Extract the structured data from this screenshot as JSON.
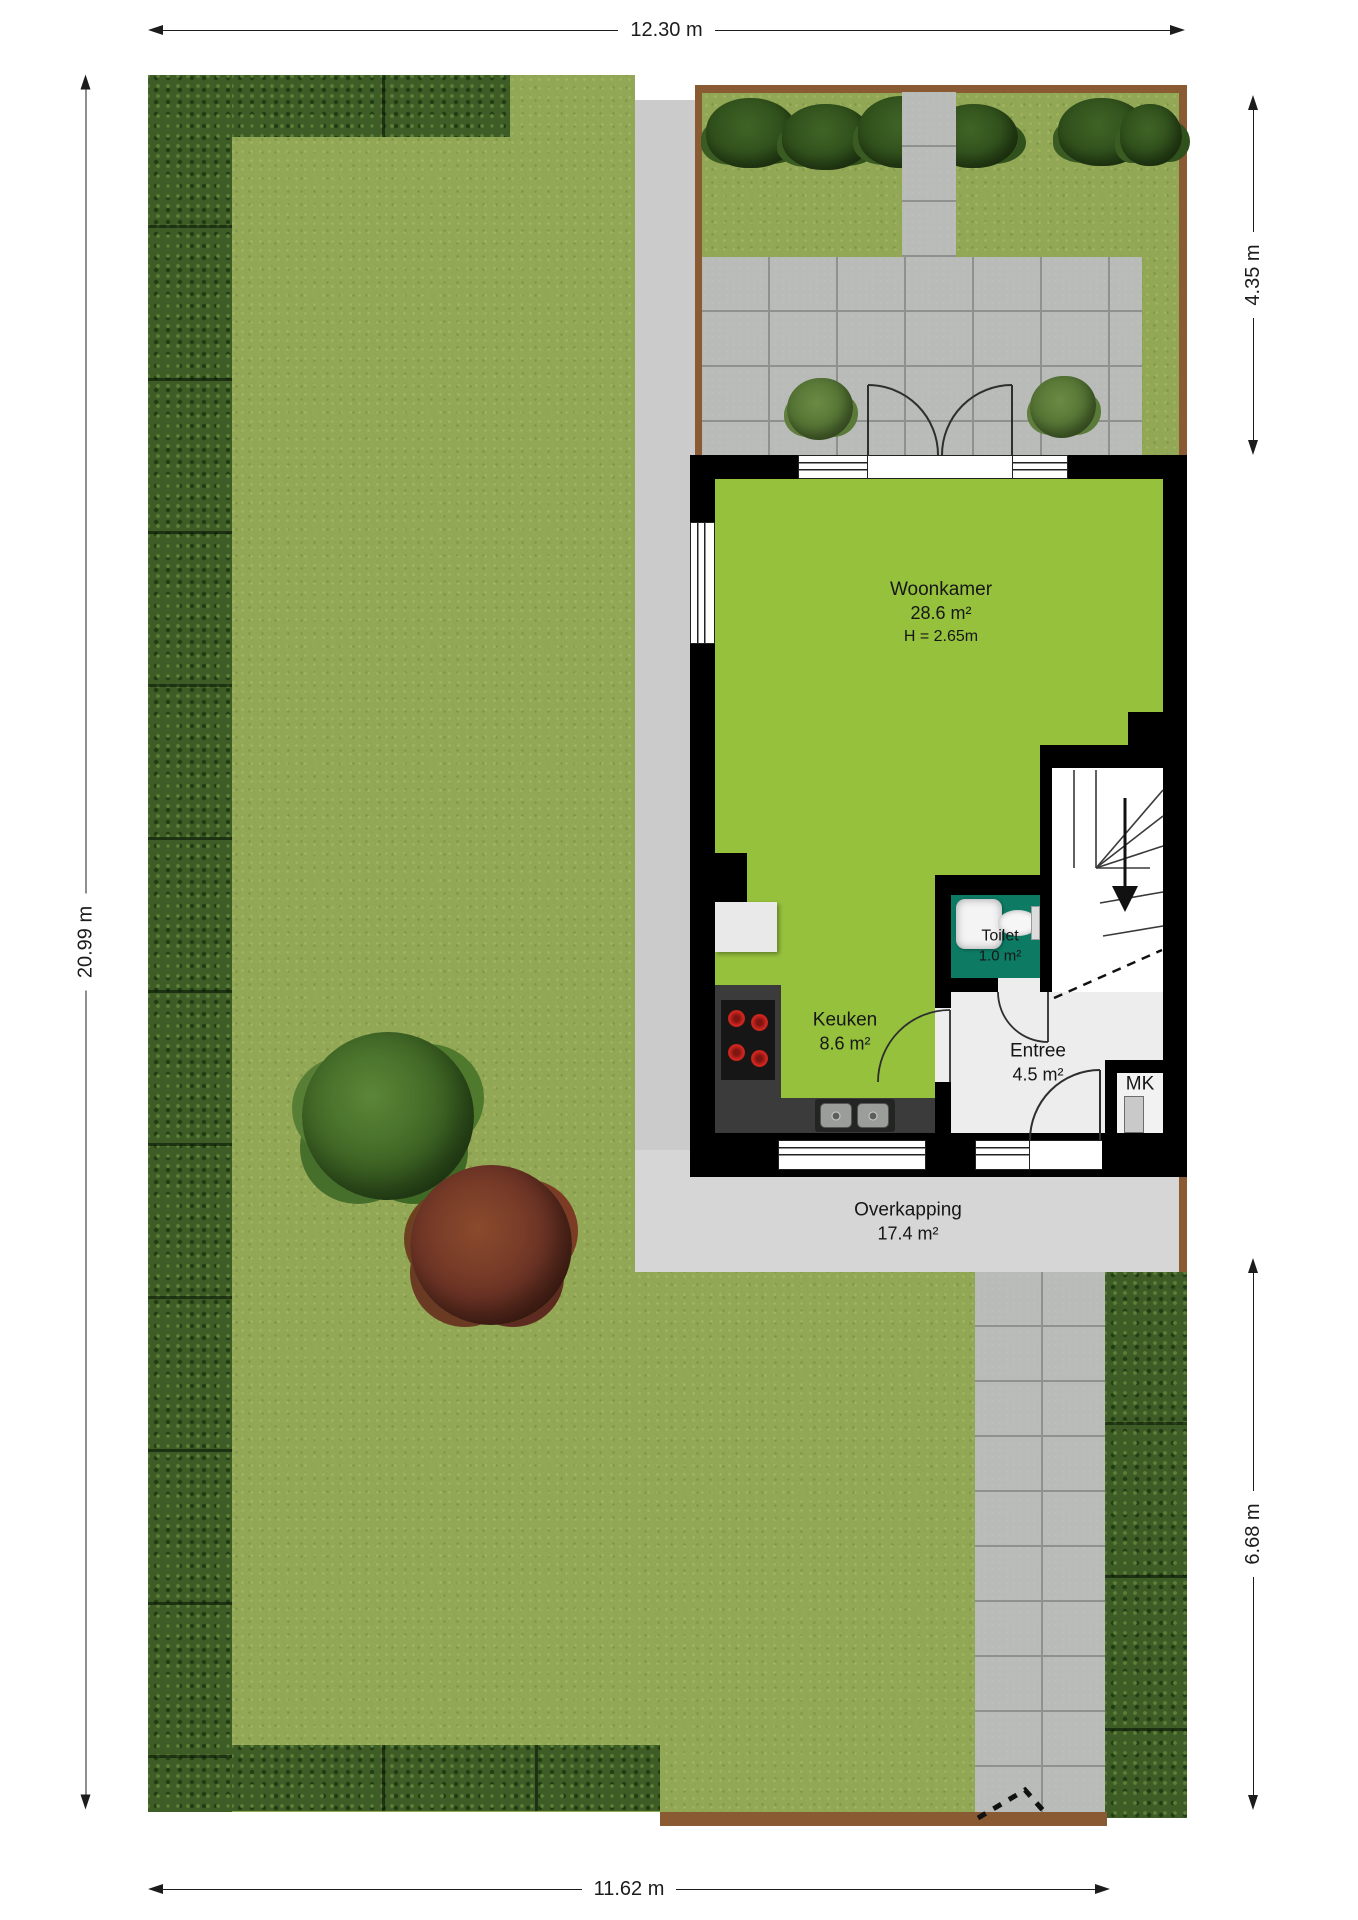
{
  "plan_type": "situation-floor-plan",
  "dimensions": {
    "top": "12.30 m",
    "left": "20.99 m",
    "right_upper": "4.35 m",
    "right_lower": "6.68 m",
    "bottom": "11.62 m"
  },
  "rooms": {
    "woonkamer": {
      "name": "Woonkamer",
      "area": "28.6 m²",
      "height": "H = 2.65m"
    },
    "keuken": {
      "name": "Keuken",
      "area": "8.6 m²"
    },
    "toilet": {
      "name": "Toilet",
      "area": "1.0 m²"
    },
    "entree": {
      "name": "Entree",
      "area": "4.5 m²"
    },
    "meterkast": {
      "name": "MK"
    },
    "overkapping": {
      "name": "Overkapping",
      "area": "17.4 m²"
    }
  },
  "colors": {
    "grass": "#93a857",
    "hedge": "#3d5c26",
    "hedge_light": "#5d8038",
    "hedge_dark": "#203a12",
    "paving": "#b9bbb9",
    "paving_line": "#8f918f",
    "walkway": "#cbcbcb",
    "overkapping_floor": "#d6d6d6",
    "wall": "#000000",
    "floor_living": "#95c13d",
    "floor_toilet": "#0d7a64",
    "floor_entree": "#ededed",
    "counter": "#3b3b3b",
    "burner": "#d2261f",
    "fence": "#8a5a33"
  }
}
